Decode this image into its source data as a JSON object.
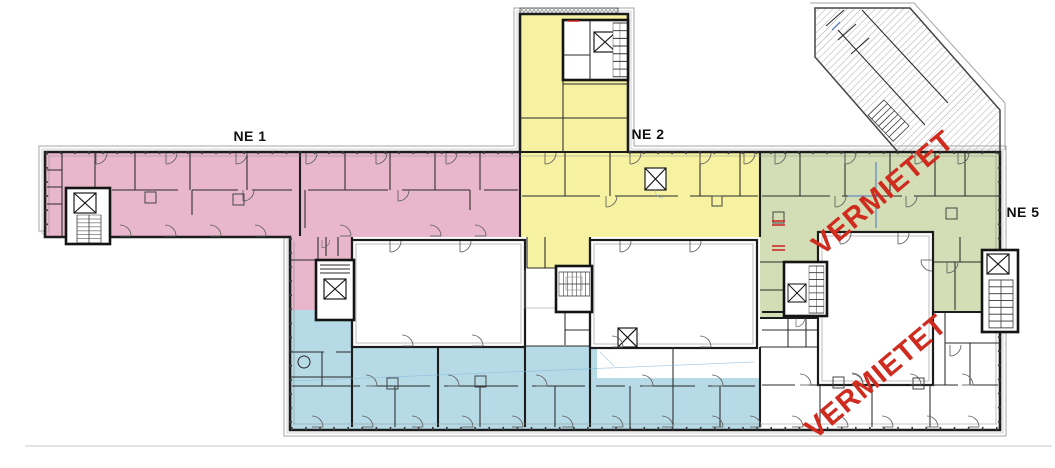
{
  "plan": {
    "background": "#ffffff",
    "wall_color": "#1c1c1c",
    "outline_color": "#a6a6a6",
    "status_color": "#cf2b1e",
    "section_marker_color": "#4472c4",
    "zones": {
      "ne1": {
        "label": "NE 1",
        "color": "#e9b7cb",
        "status": ""
      },
      "ne2": {
        "label": "NE 2",
        "color": "#f6f2a1",
        "status": ""
      },
      "ne5": {
        "label": "NE 5",
        "color": "#d3deb6",
        "status": "VERMIETET"
      },
      "south_wing": {
        "label": "",
        "color": "#b6dbe7",
        "status": ""
      },
      "southeast_unit": {
        "label": "",
        "color": "#ffffff",
        "status": "VERMIETET"
      }
    },
    "annotations": {
      "ne1": "NE 1",
      "ne2": "NE 2",
      "ne5": "NE 5",
      "vermietet_upper": "VERMIETET",
      "vermietet_lower": "VERMIETET"
    }
  }
}
